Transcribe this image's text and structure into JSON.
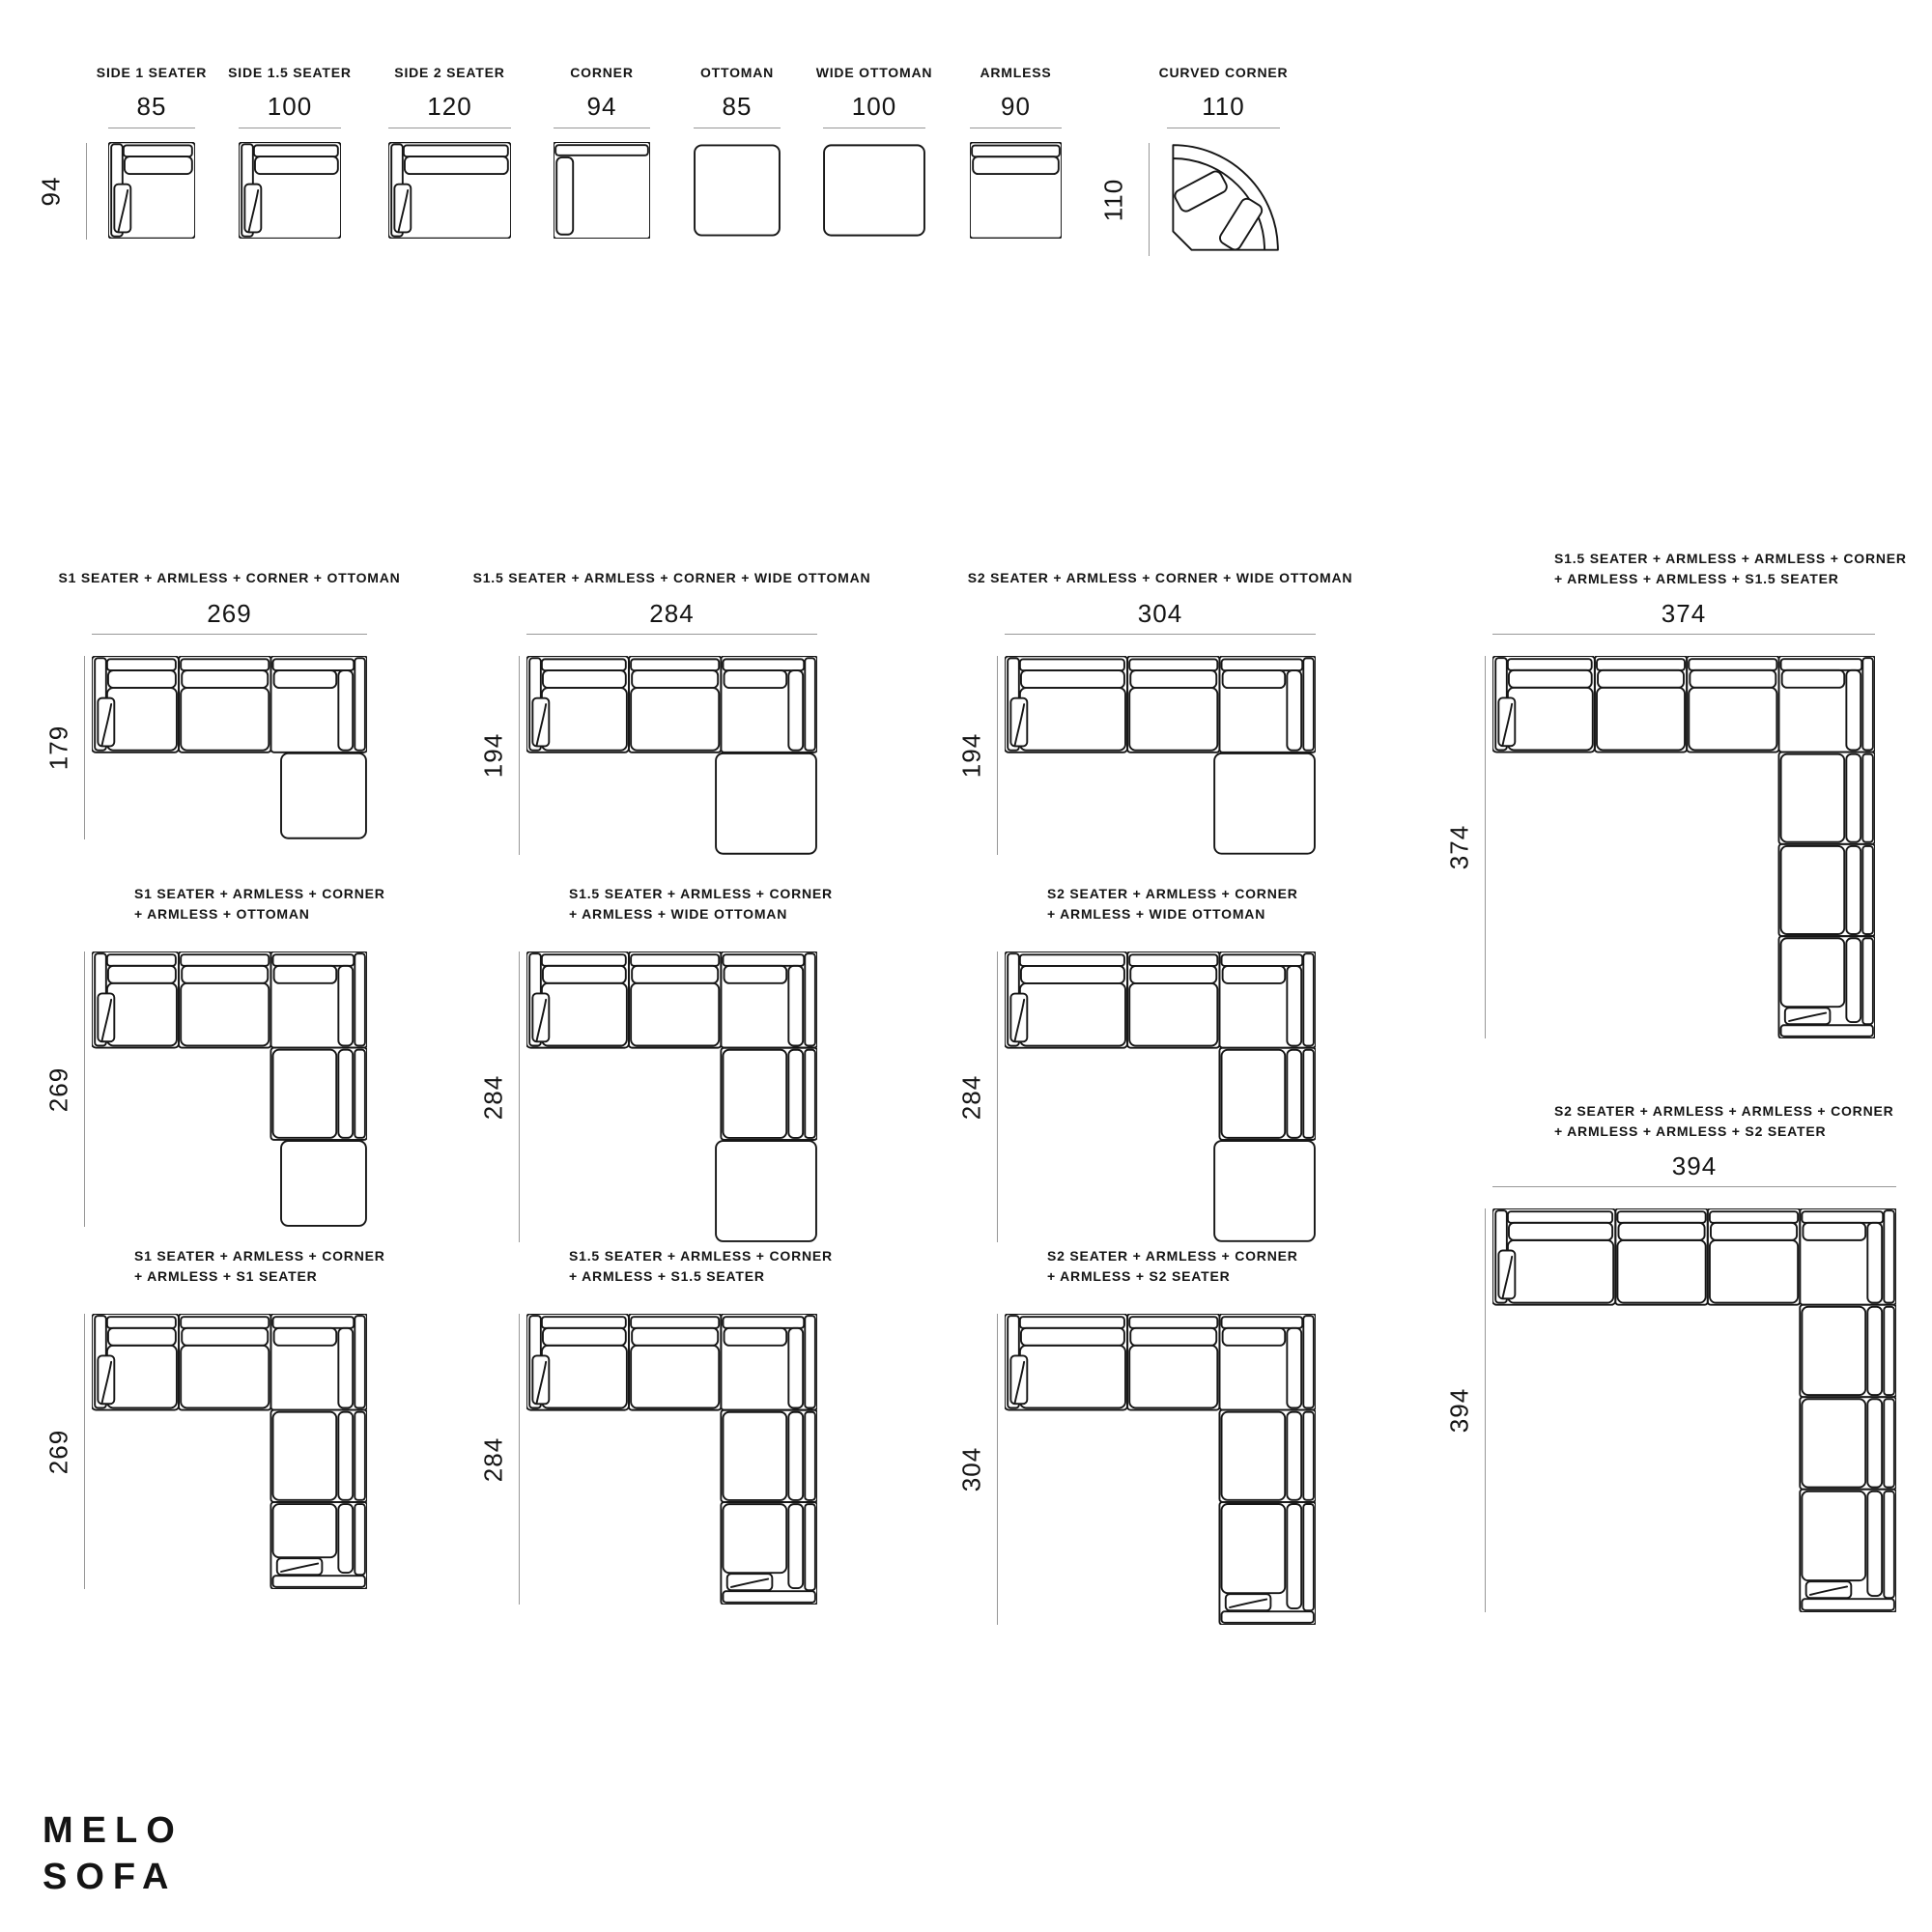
{
  "brand": {
    "name": "MELO SOFA",
    "line1": "MELO",
    "line2": "SOFA"
  },
  "modules": {
    "depth_dim": "94",
    "curved_depth_dim": "110",
    "items": [
      {
        "name": "SIDE 1 SEATER",
        "width": "85"
      },
      {
        "name": "SIDE 1.5 SEATER",
        "width": "100"
      },
      {
        "name": "SIDE 2 SEATER",
        "width": "120"
      },
      {
        "name": "CORNER",
        "width": "94"
      },
      {
        "name": "OTTOMAN",
        "width": "85"
      },
      {
        "name": "WIDE OTTOMAN",
        "width": "100"
      },
      {
        "name": "ARMLESS",
        "width": "90"
      },
      {
        "name": "CURVED CORNER",
        "width": "110"
      }
    ]
  },
  "configs": {
    "items": [
      {
        "name": "S1 SEATER + ARMLESS + CORNER + OTTOMAN",
        "width": "269",
        "height": "179"
      },
      {
        "name": "S1.5 SEATER + ARMLESS + CORNER + WIDE OTTOMAN",
        "width": "284",
        "height": "194"
      },
      {
        "name": "S2 SEATER + ARMLESS + CORNER + WIDE OTTOMAN",
        "width": "304",
        "height": "194"
      },
      {
        "name": "S1.5 SEATER + ARMLESS + ARMLESS + CORNER\n+ ARMLESS + ARMLESS + S1.5 SEATER",
        "width": "374",
        "height": "374"
      },
      {
        "name": "S1 SEATER + ARMLESS + CORNER\n+ ARMLESS + OTTOMAN",
        "height": "269"
      },
      {
        "name": "S1.5 SEATER + ARMLESS + CORNER\n+ ARMLESS + WIDE OTTOMAN",
        "height": "284"
      },
      {
        "name": "S2 SEATER + ARMLESS + CORNER\n+ ARMLESS + WIDE OTTOMAN",
        "height": "284"
      },
      {
        "name": "S2 SEATER + ARMLESS + ARMLESS + CORNER\n+ ARMLESS + ARMLESS + S2 SEATER",
        "width": "394",
        "height": "394"
      },
      {
        "name": "S1 SEATER + ARMLESS + CORNER\n+ ARMLESS + S1 SEATER",
        "height": "269"
      },
      {
        "name": "S1.5 SEATER + ARMLESS + CORNER\n+ ARMLESS + S1.5 SEATER",
        "height": "284"
      },
      {
        "name": "S2 SEATER + ARMLESS + CORNER\n+ ARMLESS + S2 SEATER",
        "height": "304"
      }
    ]
  }
}
